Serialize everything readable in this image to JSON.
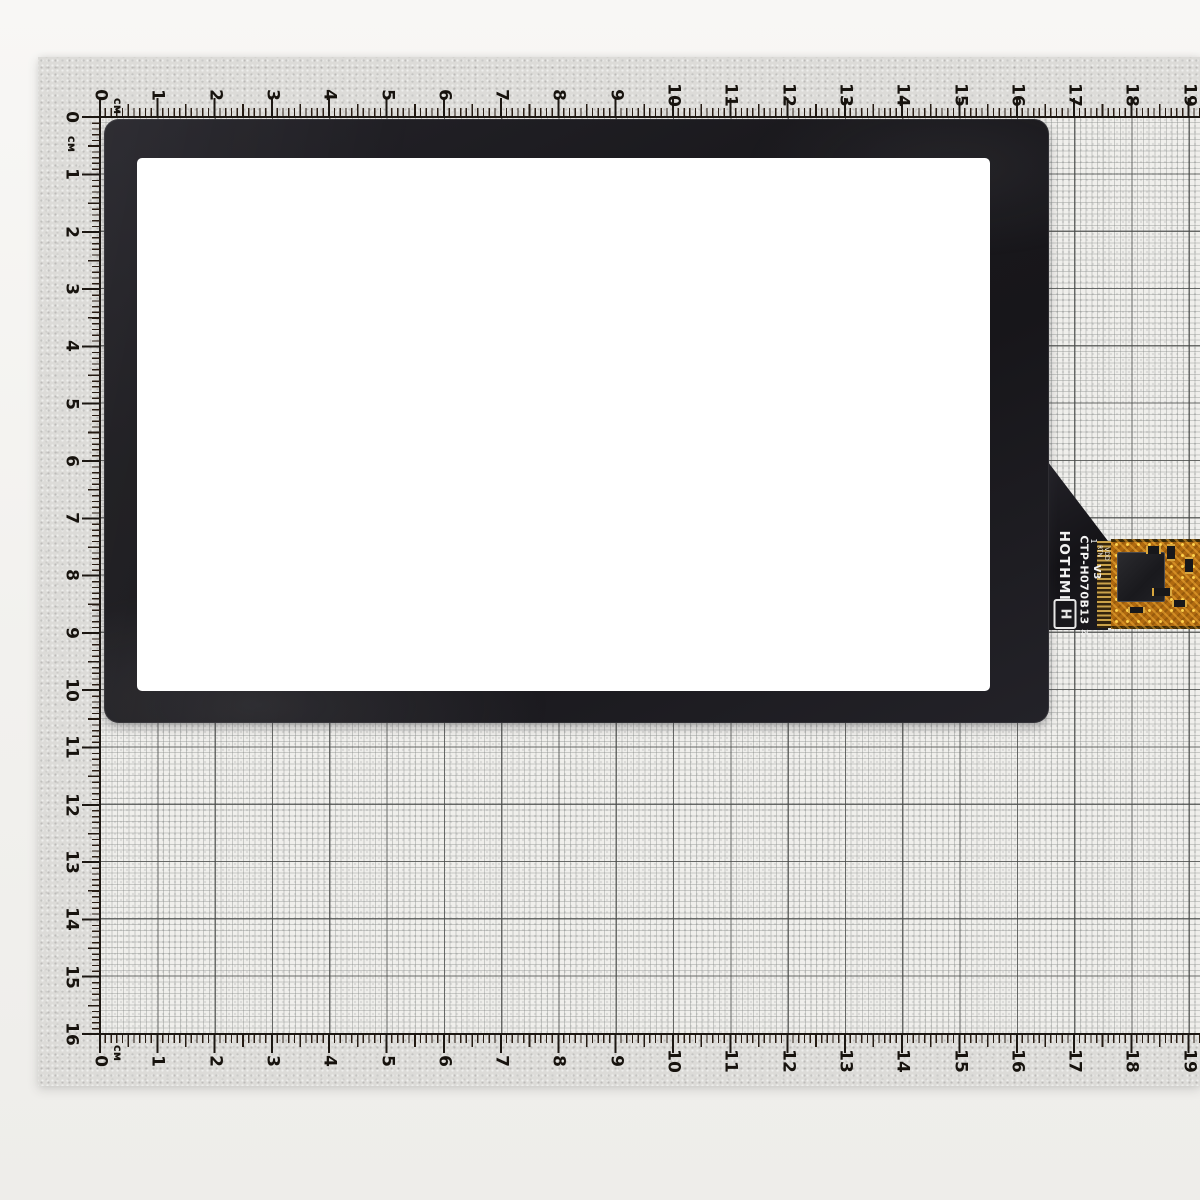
{
  "rulers": {
    "unit": "см",
    "top": [
      "0",
      "1",
      "2",
      "3",
      "4",
      "5",
      "6",
      "7",
      "8",
      "9",
      "10",
      "11",
      "12",
      "13",
      "14",
      "15",
      "16",
      "17",
      "18",
      "19"
    ],
    "left": [
      "0",
      "1",
      "2",
      "3",
      "4",
      "5",
      "6",
      "7",
      "8",
      "9",
      "10",
      "11",
      "12",
      "13",
      "14",
      "15",
      "16"
    ],
    "bottom": [
      "0",
      "1",
      "2",
      "3",
      "4",
      "5",
      "6",
      "7",
      "8",
      "9",
      "10",
      "11",
      "12",
      "13",
      "14",
      "15",
      "16",
      "17",
      "18",
      "19"
    ]
  },
  "panel": {
    "brand": "HOTHMI",
    "logo_letter": "H",
    "model": "CTP-H070B13",
    "version": "V3",
    "z_mark": "Z",
    "pin1": "1",
    "pin_rtn": "RTN",
    "pin_vdd": "VDD"
  },
  "colors": {
    "panel_frame": "#1a191d",
    "active_area": "#ffffff",
    "fpc_orange": "#b06a10",
    "mat_gray": "#dcdbd8",
    "grid_paper": "#f0efec",
    "cm_line": "#46484a",
    "silkscreen": "#f2f2f2"
  }
}
